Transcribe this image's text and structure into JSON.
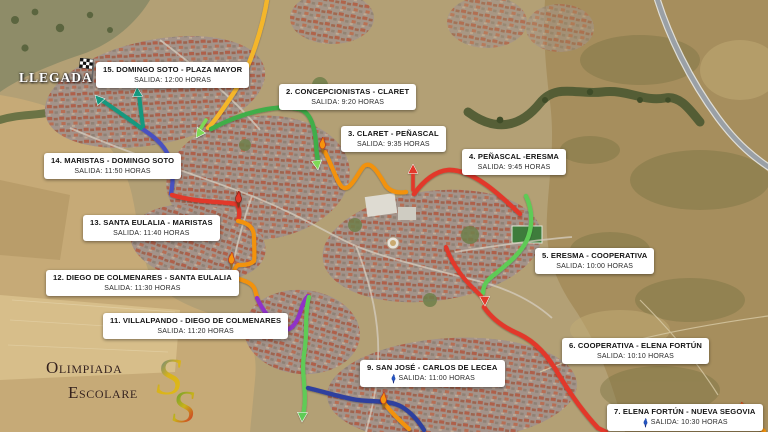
{
  "finish": {
    "label": "LLEGADA"
  },
  "logo": {
    "line1": "Olimpiada",
    "line2": "Escolare",
    "s1": "S",
    "s2": "S"
  },
  "labels": [
    {
      "num": "15",
      "title": "15. DOMINGO SOTO - PLAZA MAYOR",
      "subtitle": "SALIDA: 12:00 HORAS"
    },
    {
      "num": "2",
      "title": "2. CONCEPCIONISTAS - CLARET",
      "subtitle": "SALIDA: 9:20 HORAS"
    },
    {
      "num": "3",
      "title": "3. CLARET - PEÑASCAL",
      "subtitle": "SALIDA: 9:35 HORAS"
    },
    {
      "num": "4",
      "title": "4. PEÑASCAL -ERESMA",
      "subtitle": "SALIDA: 9:45 HORAS"
    },
    {
      "num": "14",
      "title": "14. MARISTAS - DOMINGO SOTO",
      "subtitle": "SALIDA: 11:50 HORAS"
    },
    {
      "num": "13",
      "title": "13. SANTA EULALIA - MARISTAS",
      "subtitle": "SALIDA: 11:40 HORAS"
    },
    {
      "num": "5",
      "title": "5. ERESMA - COOPERATIVA",
      "subtitle": "SALIDA: 10:00 HORAS"
    },
    {
      "num": "12",
      "title": "12. DIEGO DE COLMENARES - SANTA EULALIA",
      "subtitle": "SALIDA: 11:30 HORAS"
    },
    {
      "num": "11",
      "title": "11. VILLALPANDO - DIEGO DE COLMENARES",
      "subtitle": "SALIDA: 11:20 HORAS"
    },
    {
      "num": "6",
      "title": "6. COOPERATIVA - ELENA FORTÚN",
      "subtitle": "SALIDA: 10:10 HORAS"
    },
    {
      "num": "9",
      "title": "9. SAN JOSÉ - CARLOS DE LECEA",
      "subtitle": "SALIDA: 11:00 HORAS"
    },
    {
      "num": "7",
      "title": "7. ELENA FORTÚN - NUEVA SEGOVIA",
      "subtitle": "SALIDA: 10:30 HORAS"
    }
  ],
  "route_colors": {
    "yellow": "#F4B62C",
    "green": "#3FAE4A",
    "bright_green": "#5FCB57",
    "light_green": "#7ED957",
    "teal": "#12997F",
    "indigo": "#4A51C0",
    "navy": "#2E3F9F",
    "purple": "#9033C8",
    "red": "#E2392A",
    "orange": "#F2920E"
  },
  "icon_colors": {
    "torch_orange": "#F6930D",
    "torch_blue": "#2457C5"
  }
}
